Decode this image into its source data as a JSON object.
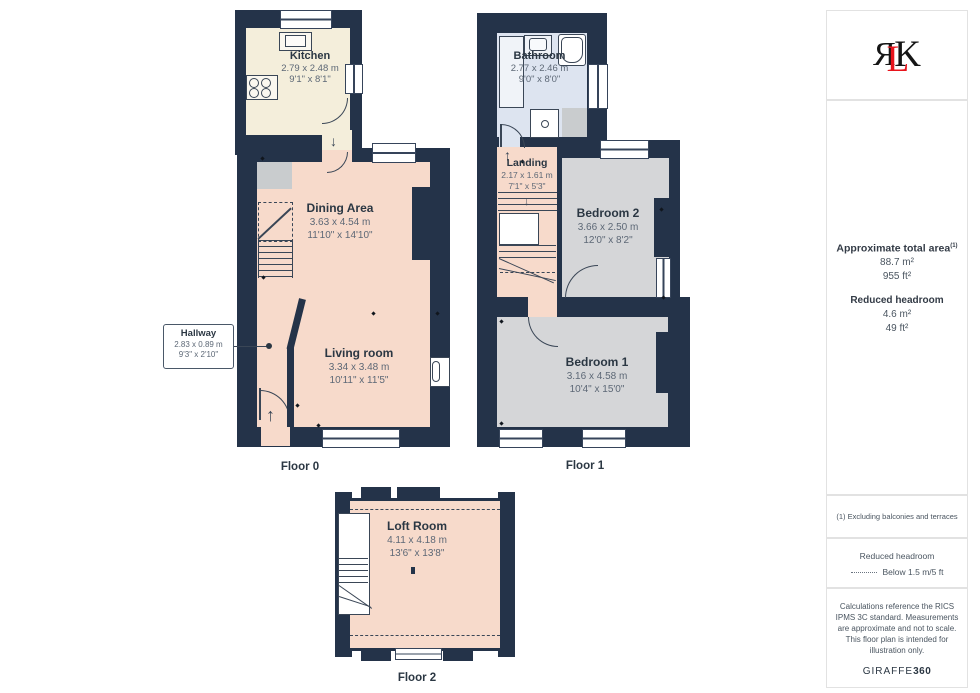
{
  "floors": [
    {
      "label": "Floor 0",
      "rooms": [
        {
          "name": "Kitchen",
          "size_m": "2.79 x 2.48 m",
          "size_ft": "9'1\" x 8'1\""
        },
        {
          "name": "Dining Area",
          "size_m": "3.63 x 4.54 m",
          "size_ft": "11'10\" x 14'10\""
        },
        {
          "name": "Living room",
          "size_m": "3.34 x 3.48 m",
          "size_ft": "10'11\" x 11'5\""
        },
        {
          "name": "Hallway",
          "size_m": "2.83 x 0.89 m",
          "size_ft": "9'3\" x 2'10\""
        }
      ]
    },
    {
      "label": "Floor 1",
      "rooms": [
        {
          "name": "Bathroom",
          "size_m": "2.77 x 2.46 m",
          "size_ft": "9'0\" x 8'0\""
        },
        {
          "name": "Landing",
          "size_m": "2.17 x 1.61 m",
          "size_ft": "7'1\" x 5'3\""
        },
        {
          "name": "Bedroom 2",
          "size_m": "3.66 x 2.50 m",
          "size_ft": "12'0\" x 8'2\""
        },
        {
          "name": "Bedroom 1",
          "size_m": "3.16 x 4.58 m",
          "size_ft": "10'4\" x 15'0\""
        }
      ]
    },
    {
      "label": "Floor 2",
      "rooms": [
        {
          "name": "Loft Room",
          "size_m": "4.11 x 4.18 m",
          "size_ft": "13'6\" x 13'8\""
        }
      ]
    }
  ],
  "icons": {
    "up": "↑",
    "down": "↓"
  },
  "sidebar": {
    "logo": {
      "r": "R",
      "l": "L",
      "k": "K"
    },
    "area_title": "Approximate total area",
    "area_sup": "(1)",
    "area_m2": "88.7 m²",
    "area_ft2": "955 ft²",
    "rh_title": "Reduced headroom",
    "rh_m2": "4.6 m²",
    "rh_ft2": "49 ft²",
    "footnote": "(1) Excluding balconies and terraces",
    "legend_title": "Reduced headroom",
    "legend_item": "Below 1.5 m/5 ft",
    "disclaimer": "Calculations reference the RICS IPMS 3C standard. Measurements are approximate and not to scale. This floor plan is intended for illustration only.",
    "brand": "GIRAFFE",
    "brand_bold": "360"
  },
  "colors": {
    "walls": "#243349",
    "kitchen": "#f4eedb",
    "living_areas": "#f7dacb",
    "bathroom": "#dde4f0",
    "bedrooms": "#d5d6d8",
    "logo_red": "#e8141c"
  }
}
